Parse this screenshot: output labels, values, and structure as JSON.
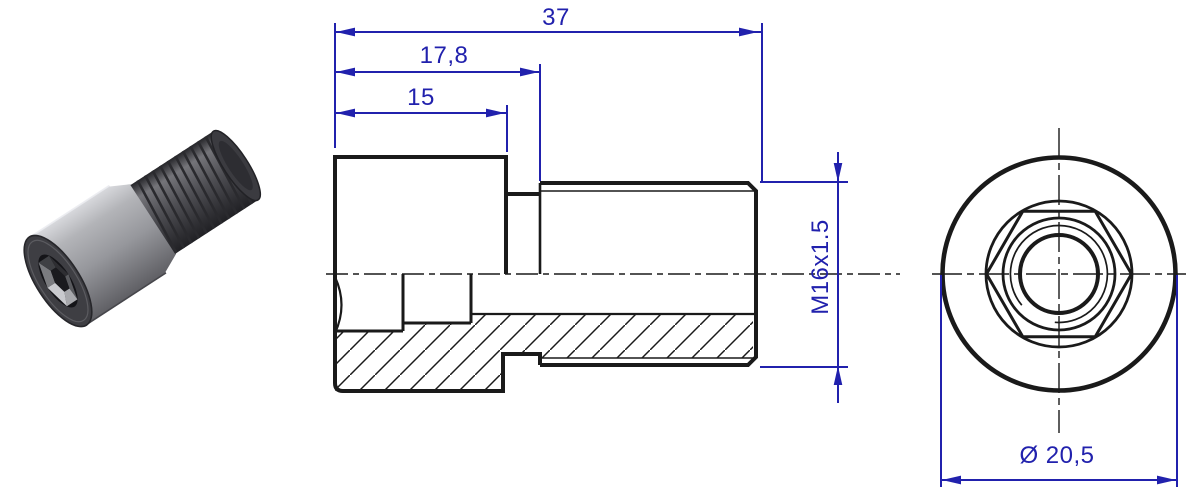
{
  "dimensions": {
    "overall_length": "37",
    "length_to_thread_start": "17,8",
    "head_length": "15",
    "thread_spec": "M16x1.5",
    "head_diameter": "Ø 20,5"
  },
  "colors": {
    "dimension_blue": "#2121ad",
    "line_black": "#1a1a1a",
    "background": "#ffffff"
  }
}
